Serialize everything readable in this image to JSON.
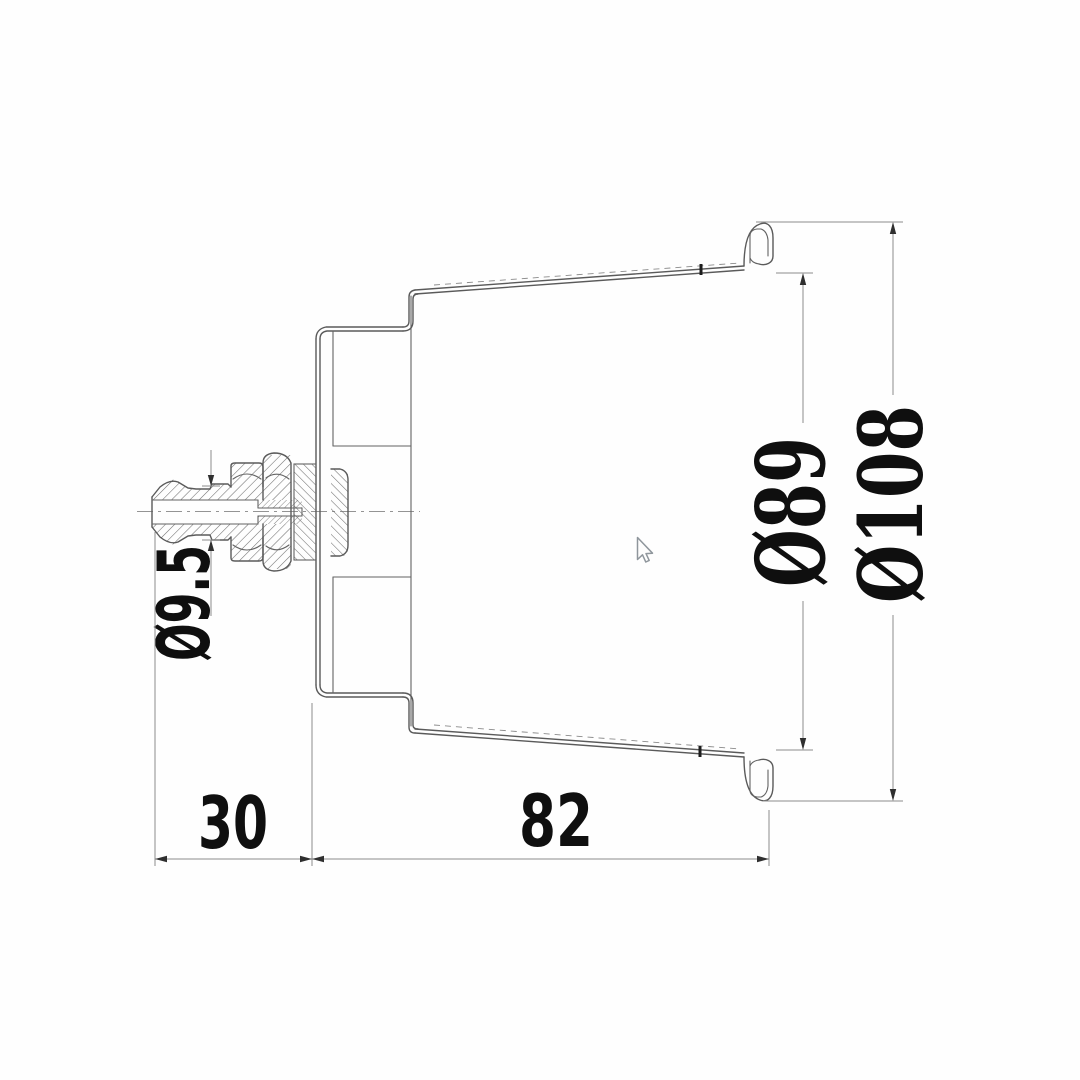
{
  "drawing": {
    "kind": "technical-cross-section",
    "labels": {
      "barb_od": "Ø9.5",
      "flange_offset": "30",
      "body_depth": "82",
      "rim_inner_dia": "Ø89",
      "rim_outer_dia": "Ø108"
    },
    "colors": {
      "background": "#fefefe",
      "outline": "#5a5a5a",
      "hatching": "#6f6f6f",
      "dimension_lines": "#8c8c8c",
      "dimension_text": "#0f0f0f",
      "arrowheads": "#2f2f2f",
      "cursor": "#8f969c"
    }
  }
}
